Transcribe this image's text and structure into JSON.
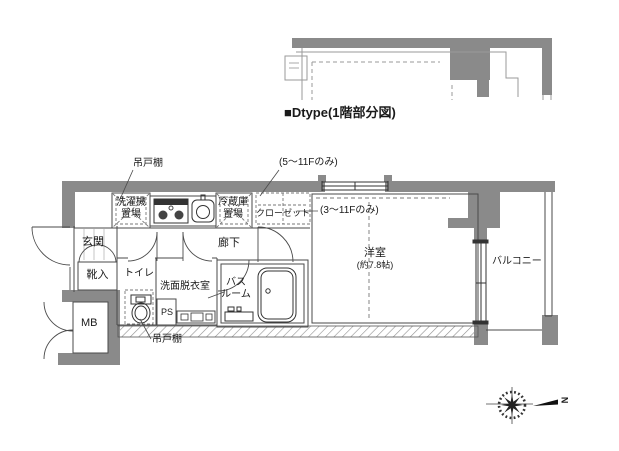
{
  "title": "■Dtype(1階部分図)",
  "floor_plan": {
    "labels": {
      "hanging_cupboard_top": "吊戸棚",
      "floors_5_11_note": "(5〜11Fのみ)",
      "floors_3_11_note": "(3〜11Fのみ)",
      "washer_line1": "洗濯機",
      "washer_line2": "置場",
      "fridge_line1": "冷蔵庫",
      "fridge_line2": "置場",
      "closet": "クローゼット",
      "entrance": "玄関",
      "shoe_box": "靴入",
      "toilet": "トイレ",
      "corridor": "廊下",
      "washroom": "洗面脱衣室",
      "bath_line1": "バス",
      "bath_line2": "ルーム",
      "pipe_space": "PS",
      "meter_box": "MB",
      "hanging_cupboard_bottom": "吊戸棚",
      "western_room": "洋室",
      "western_room_size": "(約7.8帖)",
      "balcony": "バルコニー"
    },
    "compass": {
      "north_label": "N"
    },
    "colors": {
      "wall": "#8a8a8a",
      "line": "#4a4a4a",
      "hatch": "#909090"
    }
  }
}
